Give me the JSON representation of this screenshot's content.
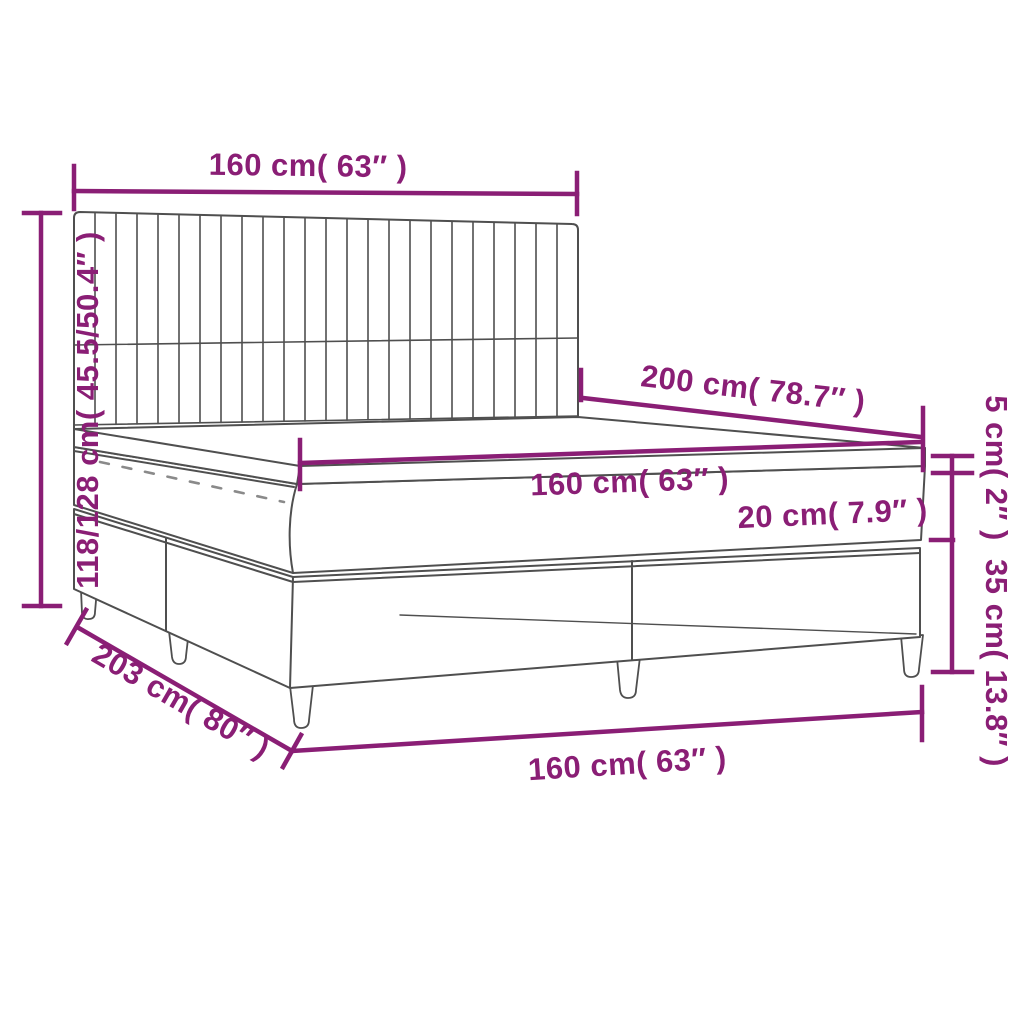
{
  "diagram": {
    "title": "Box spring bed with mattress — dimension diagram",
    "colors": {
      "dimension": "#8a1e75",
      "line_art": "#4f4f4f",
      "zipper": "#8a8a8a",
      "background": "#ffffff"
    },
    "labels": {
      "headboard_width": "160 cm( 63″ )",
      "overall_height": "118/128 cm( 45.5/50.4″ )",
      "mattress_length": "200 cm( 78.7″ )",
      "mattress_width": "160 cm( 63″ )",
      "mattress_thickness": "20 cm( 7.9″ )",
      "topper_thickness": "5 cm( 2″ )",
      "base_height": "35 cm( 13.8″ )",
      "overall_length": "203 cm( 80″ )",
      "bed_width": "160 cm( 63″ )"
    }
  }
}
